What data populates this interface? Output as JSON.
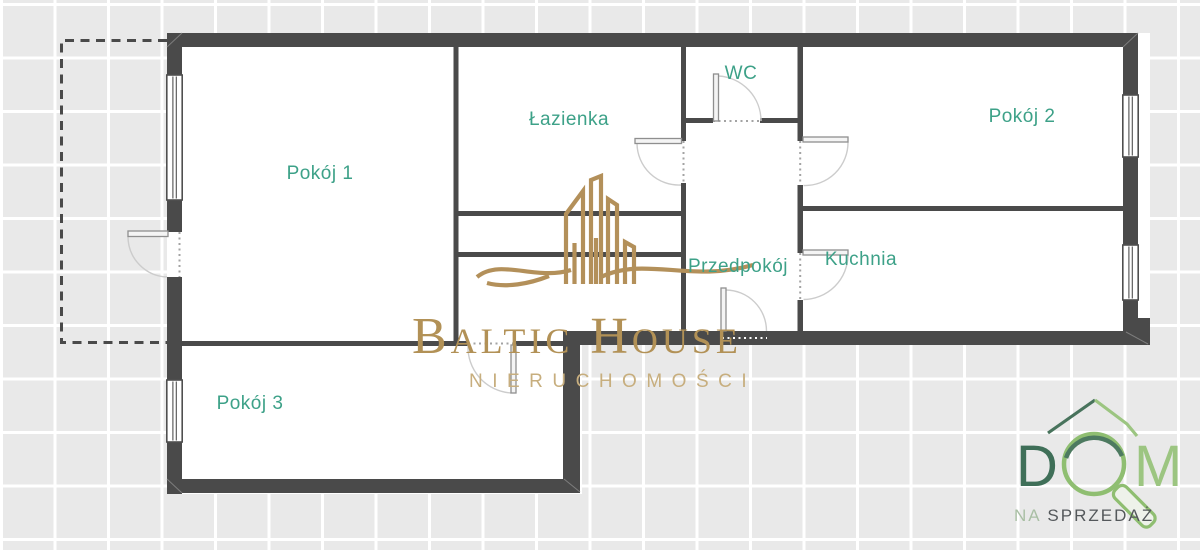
{
  "page": {
    "background_color": "#e9e9e9",
    "grid_line_color": "#ffffff"
  },
  "floor_plan": {
    "wall_color": "#4a4a4a",
    "label_color": "#3da188",
    "rooms": {
      "pokoj1": {
        "label": "Pokój 1"
      },
      "pokoj2": {
        "label": "Pokój 2"
      },
      "pokoj3": {
        "label": "Pokój 3"
      },
      "lazienka": {
        "label": "Łazienka"
      },
      "wc": {
        "label": "WC"
      },
      "przedpokoj": {
        "label": "Przedpokój"
      },
      "kuchnia": {
        "label": "Kuchnia"
      }
    }
  },
  "watermark": {
    "brand": "Baltic House",
    "tagline": "NIERUCHOMOŚCI",
    "brand_color": "#b29156",
    "tagline_color": "#c7ae7e",
    "icon_color": "#b3905a"
  },
  "sale_badge": {
    "letter_d": "D",
    "letter_m": "M",
    "prefix": "NA",
    "word": "SPRZEDAŻ",
    "dark_green": "#48735c",
    "light_green": "#8fbe71"
  }
}
